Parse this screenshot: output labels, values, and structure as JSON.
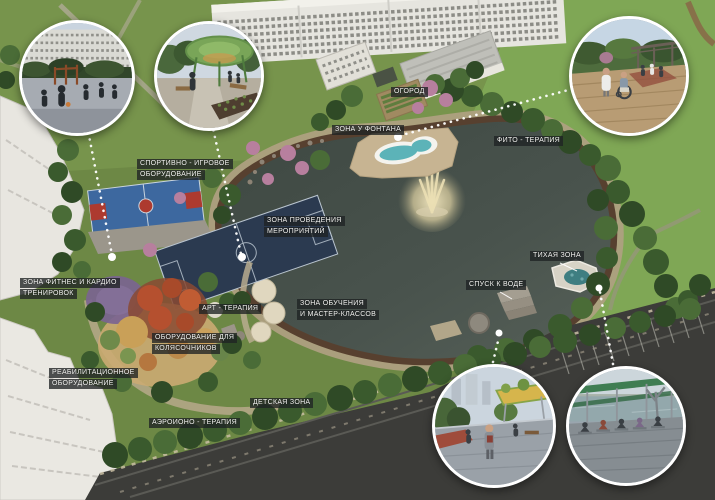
{
  "labels": {
    "sport": {
      "line1": "СПОРТИВНО - ИГРОВОЕ",
      "line2": "ОБОРУДОВАНИЕ"
    },
    "garden": {
      "line1": "ОГОРОД"
    },
    "fountain_zone": {
      "line1": "ЗОНА У ФОНТАНА"
    },
    "phyto": {
      "line1": "ФИТО - ТЕРАПИЯ"
    },
    "events": {
      "line1": "ЗОНА ПРОВЕДЕНИЯ",
      "line2": "МЕРОПРИЯТИЙ"
    },
    "education": {
      "line1": "ЗОНА ОБУЧЕНИЯ",
      "line2": "И МАСТЕР-КЛАССОВ"
    },
    "quiet": {
      "line1": "ТИХАЯ ЗОНА"
    },
    "water_access": {
      "line1": "СПУСК К ВОДЕ"
    },
    "fitness": {
      "line1": "ЗОНА ФИТНЕС И КАРДИО",
      "line2": "ТРЕНИРОВОК"
    },
    "art": {
      "line1": "АРТ - ТЕРАПИЯ"
    },
    "wheelchair": {
      "line1": "ОБОРУДОВАНИЕ ДЛЯ",
      "line2": "КОЛЯСОЧНИКОВ"
    },
    "rehab": {
      "line1": "РЕАБИЛИТАЦИОННОЕ",
      "line2": "ОБОРУДОВАНИЕ"
    },
    "children": {
      "line1": "ДЕТСКАЯ ЗОНА"
    },
    "aeroion": {
      "line1": "АЭРОИОНО - ТЕРАПИЯ"
    }
  },
  "insets": {
    "sports_court": "workout-and-basketball-court-view",
    "pavilion": "green-canopy-garden-pavilion-view",
    "rehab_garden": "nurse-with-wheelchair-patient-boardwalk-view",
    "promenade": "lakeside-promenade-with-canopy-view",
    "yoga_deck": "waterfront-yoga-deck-under-pergola-view"
  },
  "colors": {
    "pond": "#47514b",
    "lawn": "#7fa755",
    "track": "#57402f",
    "court_blue": "#3d689f",
    "court_red": "#ad3a2f",
    "pitch_navy": "#2b3a50",
    "label_bg": "rgba(31,34,36,0.78)",
    "label_text": "#f4f4f2",
    "leader": "#ffffff"
  }
}
